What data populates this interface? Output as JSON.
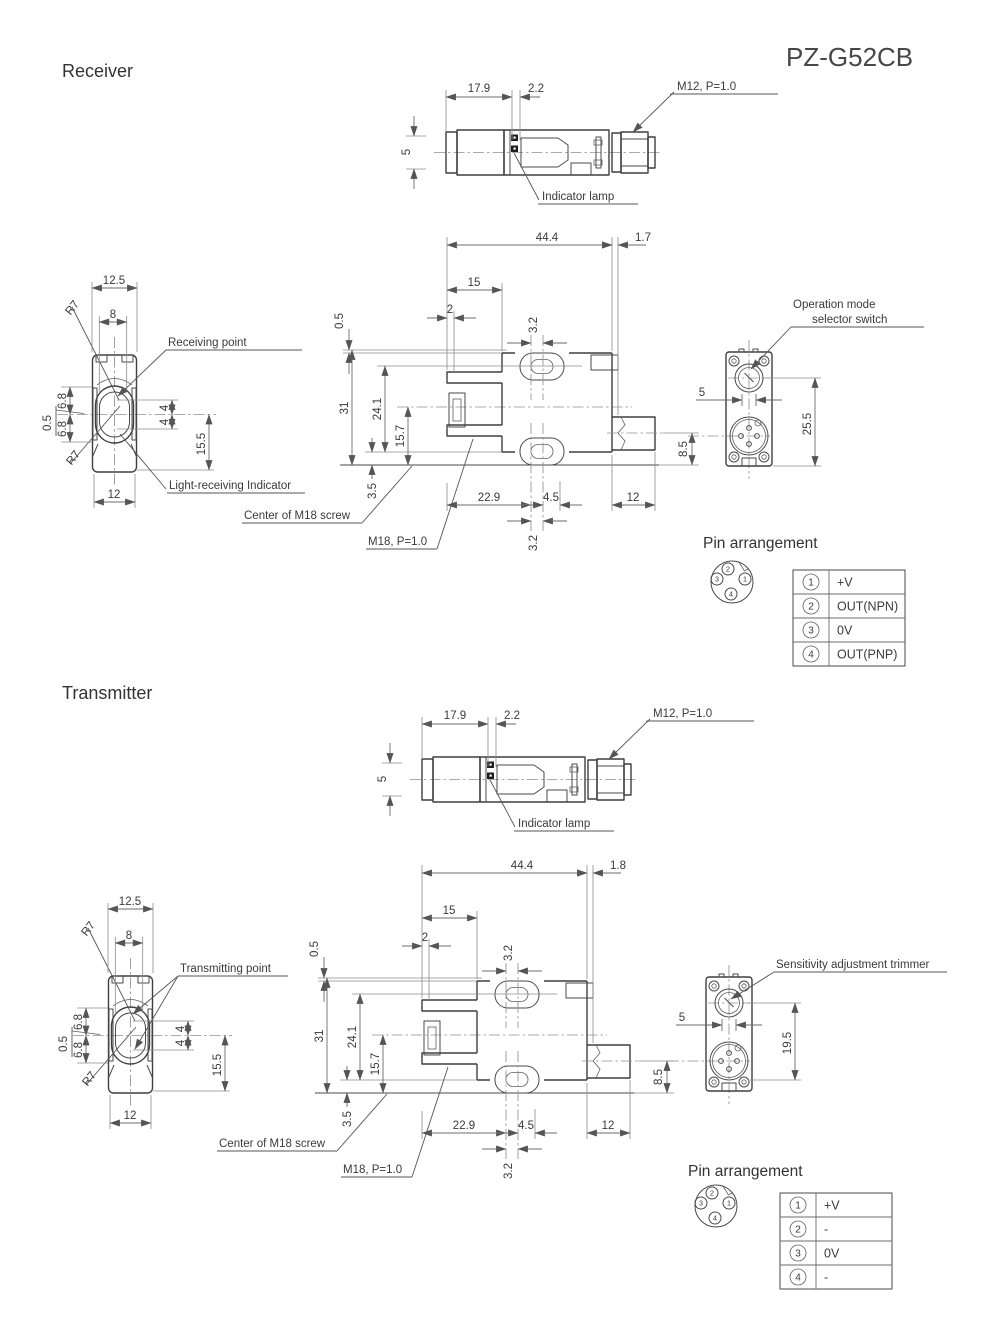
{
  "model": "PZ-G52CB",
  "receiver": {
    "title": "Receiver",
    "top_view": {
      "width": "17.9",
      "offset": "2.2",
      "height": "5",
      "connector_label": "M12, P=1.0",
      "lamp_label": "Indicator lamp"
    },
    "front_view": {
      "outer_width": "12.5",
      "slot_width": "8",
      "radius_top": "R7",
      "radius_bottom": "R7",
      "upper": "6.8",
      "lower": "6.8",
      "offset": "0.5",
      "center_up": "4",
      "center_down": "4",
      "lower_height": "15.5",
      "bottom_width": "12",
      "point_label": "Receiving point",
      "indicator_label": "Light-receiving Indicator"
    },
    "side_view": {
      "length": "44.4",
      "tail": "1.7",
      "flange": "15",
      "step": "2",
      "offset": "0.5",
      "slot_top": "3.2",
      "height": "31",
      "hole_span": "24.1",
      "axis_bottom": "15.7",
      "base": "3.5",
      "bottom1": "22.9",
      "bottom2": "4.5",
      "bottom3": "12",
      "slot_bottom": "3.2",
      "connector_offset": "8.5",
      "center_label": "Center of M18 screw",
      "screw_label": "M18, P=1.0"
    },
    "rear_view": {
      "label_line1": "Operation mode",
      "label_line2": "selector switch",
      "switch_offset": "5",
      "height": "25.5"
    },
    "pin": {
      "title": "Pin arrangement",
      "diagram": {
        "top": "2",
        "right": "1",
        "left": "3",
        "bottom": "4"
      },
      "rows": [
        {
          "no": "1",
          "label": "+V"
        },
        {
          "no": "2",
          "label": "OUT(NPN)"
        },
        {
          "no": "3",
          "label": "0V"
        },
        {
          "no": "4",
          "label": "OUT(PNP)"
        }
      ]
    }
  },
  "transmitter": {
    "title": "Transmitter",
    "top_view": {
      "width": "17.9",
      "offset": "2.2",
      "height": "5",
      "connector_label": "M12, P=1.0",
      "lamp_label": "Indicator lamp"
    },
    "front_view": {
      "outer_width": "12.5",
      "slot_width": "8",
      "radius_top": "R7",
      "radius_bottom": "R7",
      "upper": "6.8",
      "lower": "6.8",
      "offset": "0.5",
      "center_up": "4",
      "center_down": "4",
      "lower_height": "15.5",
      "bottom_width": "12",
      "point_label": "Transmitting point"
    },
    "side_view": {
      "length": "44.4",
      "tail": "1.8",
      "flange": "15",
      "step": "2",
      "offset": "0.5",
      "slot_top": "3.2",
      "height": "31",
      "hole_span": "24.1",
      "axis_bottom": "15.7",
      "base": "3.5",
      "bottom1": "22.9",
      "bottom2": "4.5",
      "bottom3": "12",
      "slot_bottom": "3.2",
      "connector_offset": "8.5",
      "center_label": "Center of M18 screw",
      "screw_label": "M18, P=1.0"
    },
    "rear_view": {
      "label": "Sensitivity adjustment trimmer",
      "switch_offset": "5",
      "height": "19.5"
    },
    "pin": {
      "title": "Pin arrangement",
      "diagram": {
        "top": "2",
        "right": "1",
        "left": "3",
        "bottom": "4"
      },
      "rows": [
        {
          "no": "1",
          "label": "+V"
        },
        {
          "no": "2",
          "label": "-"
        },
        {
          "no": "3",
          "label": "0V"
        },
        {
          "no": "4",
          "label": "-"
        }
      ]
    }
  }
}
